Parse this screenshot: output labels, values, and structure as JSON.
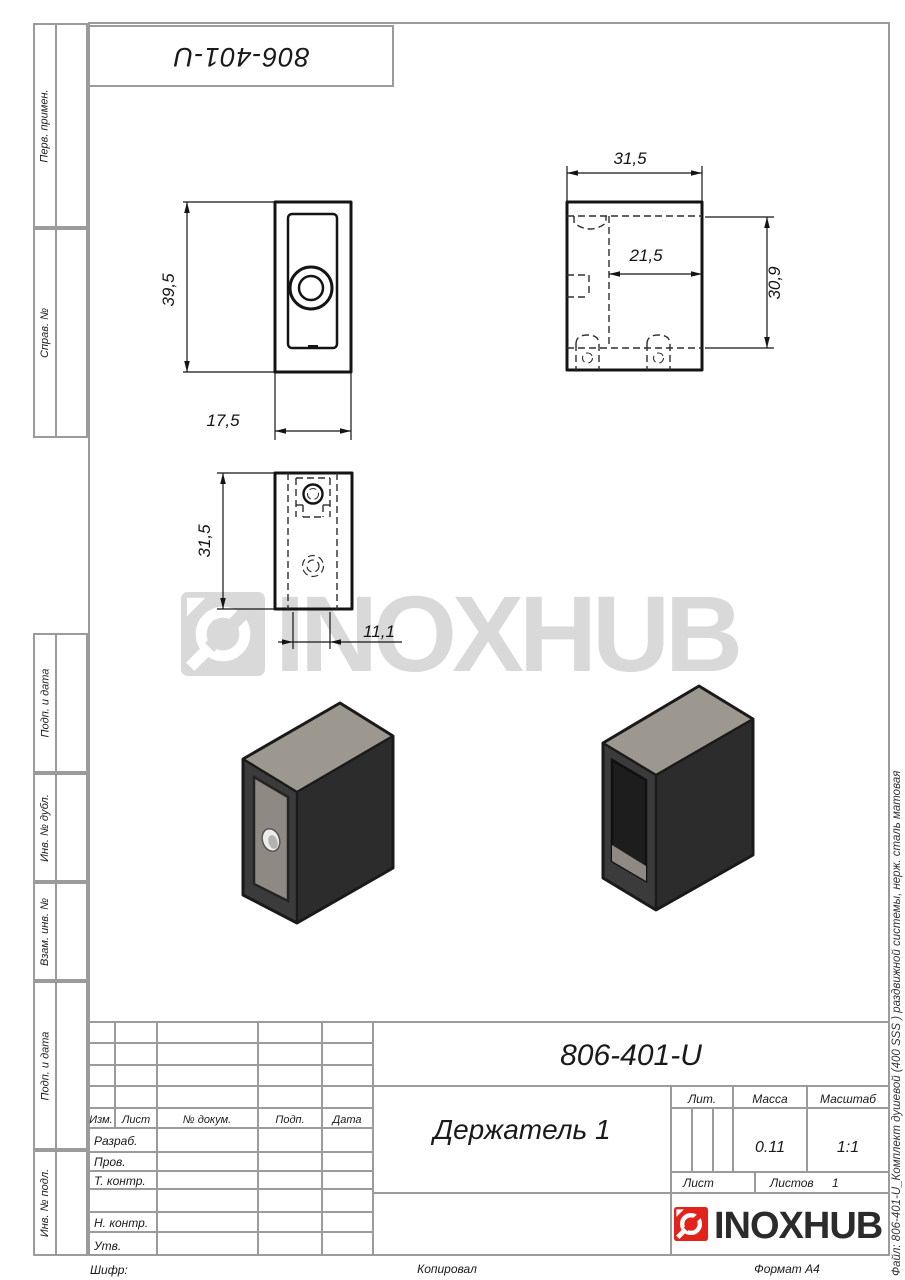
{
  "sheet": {
    "stamp_designation": "806-401-U",
    "file_note": "Файл: 806-401-U_Комплект душевой (400 SSS ) раздвижной системы, нерж. сталь матовая",
    "footer": {
      "cipher": "Шифр:",
      "copied": "Копировал",
      "format": "Формат А4"
    }
  },
  "sidebar": {
    "labels": [
      "Перв. примен.",
      "Справ. №",
      "Подп. и дата",
      "Инв. № дубл.",
      "Взам. инв. №",
      "Подп. и дата",
      "Инв. № подл."
    ]
  },
  "watermark": {
    "text": "INOXHUB",
    "color": "#d9d9d9"
  },
  "brand": {
    "name": "INOXHUB",
    "red": "#e3231b",
    "text_color": "#2b2b2b"
  },
  "views": {
    "front": {
      "height": "39,5",
      "width": "17,5"
    },
    "side": {
      "width": "31,5",
      "inner_width": "21,5",
      "height": "30,9"
    },
    "top": {
      "length": "31,5",
      "width": "11,1"
    }
  },
  "title_block": {
    "designation": "806-401-U",
    "part_name": "Держатель 1",
    "headers": {
      "lit": "Лит.",
      "mass": "Масса",
      "scale": "Масштаб",
      "sheet": "Лист",
      "sheets": "Листов",
      "izm": "Изм.",
      "list": "Лист",
      "doc": "№ докум.",
      "sign": "Подп.",
      "date": "Дата"
    },
    "values": {
      "mass": "0.11",
      "scale": "1:1",
      "sheets_count": "1"
    },
    "staff": [
      "Разраб.",
      "Пров.",
      "Т. контр.",
      "Н. контр.",
      "Утв."
    ]
  },
  "colors": {
    "form_lines": "#9b9b9b",
    "ink": "#141414",
    "iso_top_face": "#9c978f",
    "iso_dark_face": "#2c2c2c",
    "iso_side_face": "#3b3b3b"
  }
}
